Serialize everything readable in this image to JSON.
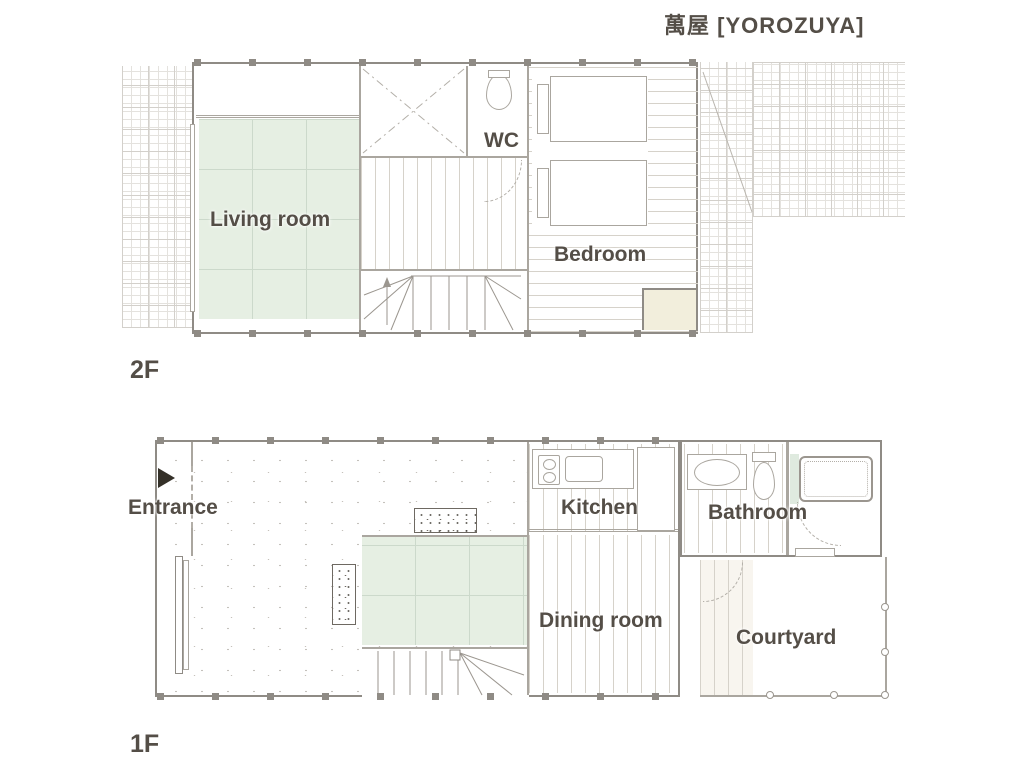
{
  "title": "萬屋 [YOROZUYA]",
  "floor2": {
    "label": "2F",
    "rooms": {
      "living": "Living room",
      "wc": "WC",
      "bedroom": "Bedroom"
    }
  },
  "floor1": {
    "label": "1F",
    "rooms": {
      "entrance": "Entrance",
      "kitchen": "Kitchen",
      "bathroom": "Bathroom",
      "dining": "Dining room",
      "courtyard": "Courtyard"
    }
  },
  "colors": {
    "label_text": "#544e47",
    "wall": "#8f8b85",
    "tatami": "#e6efe3",
    "closet": "#f2eedc",
    "bath_tile": "#dfeadf"
  }
}
